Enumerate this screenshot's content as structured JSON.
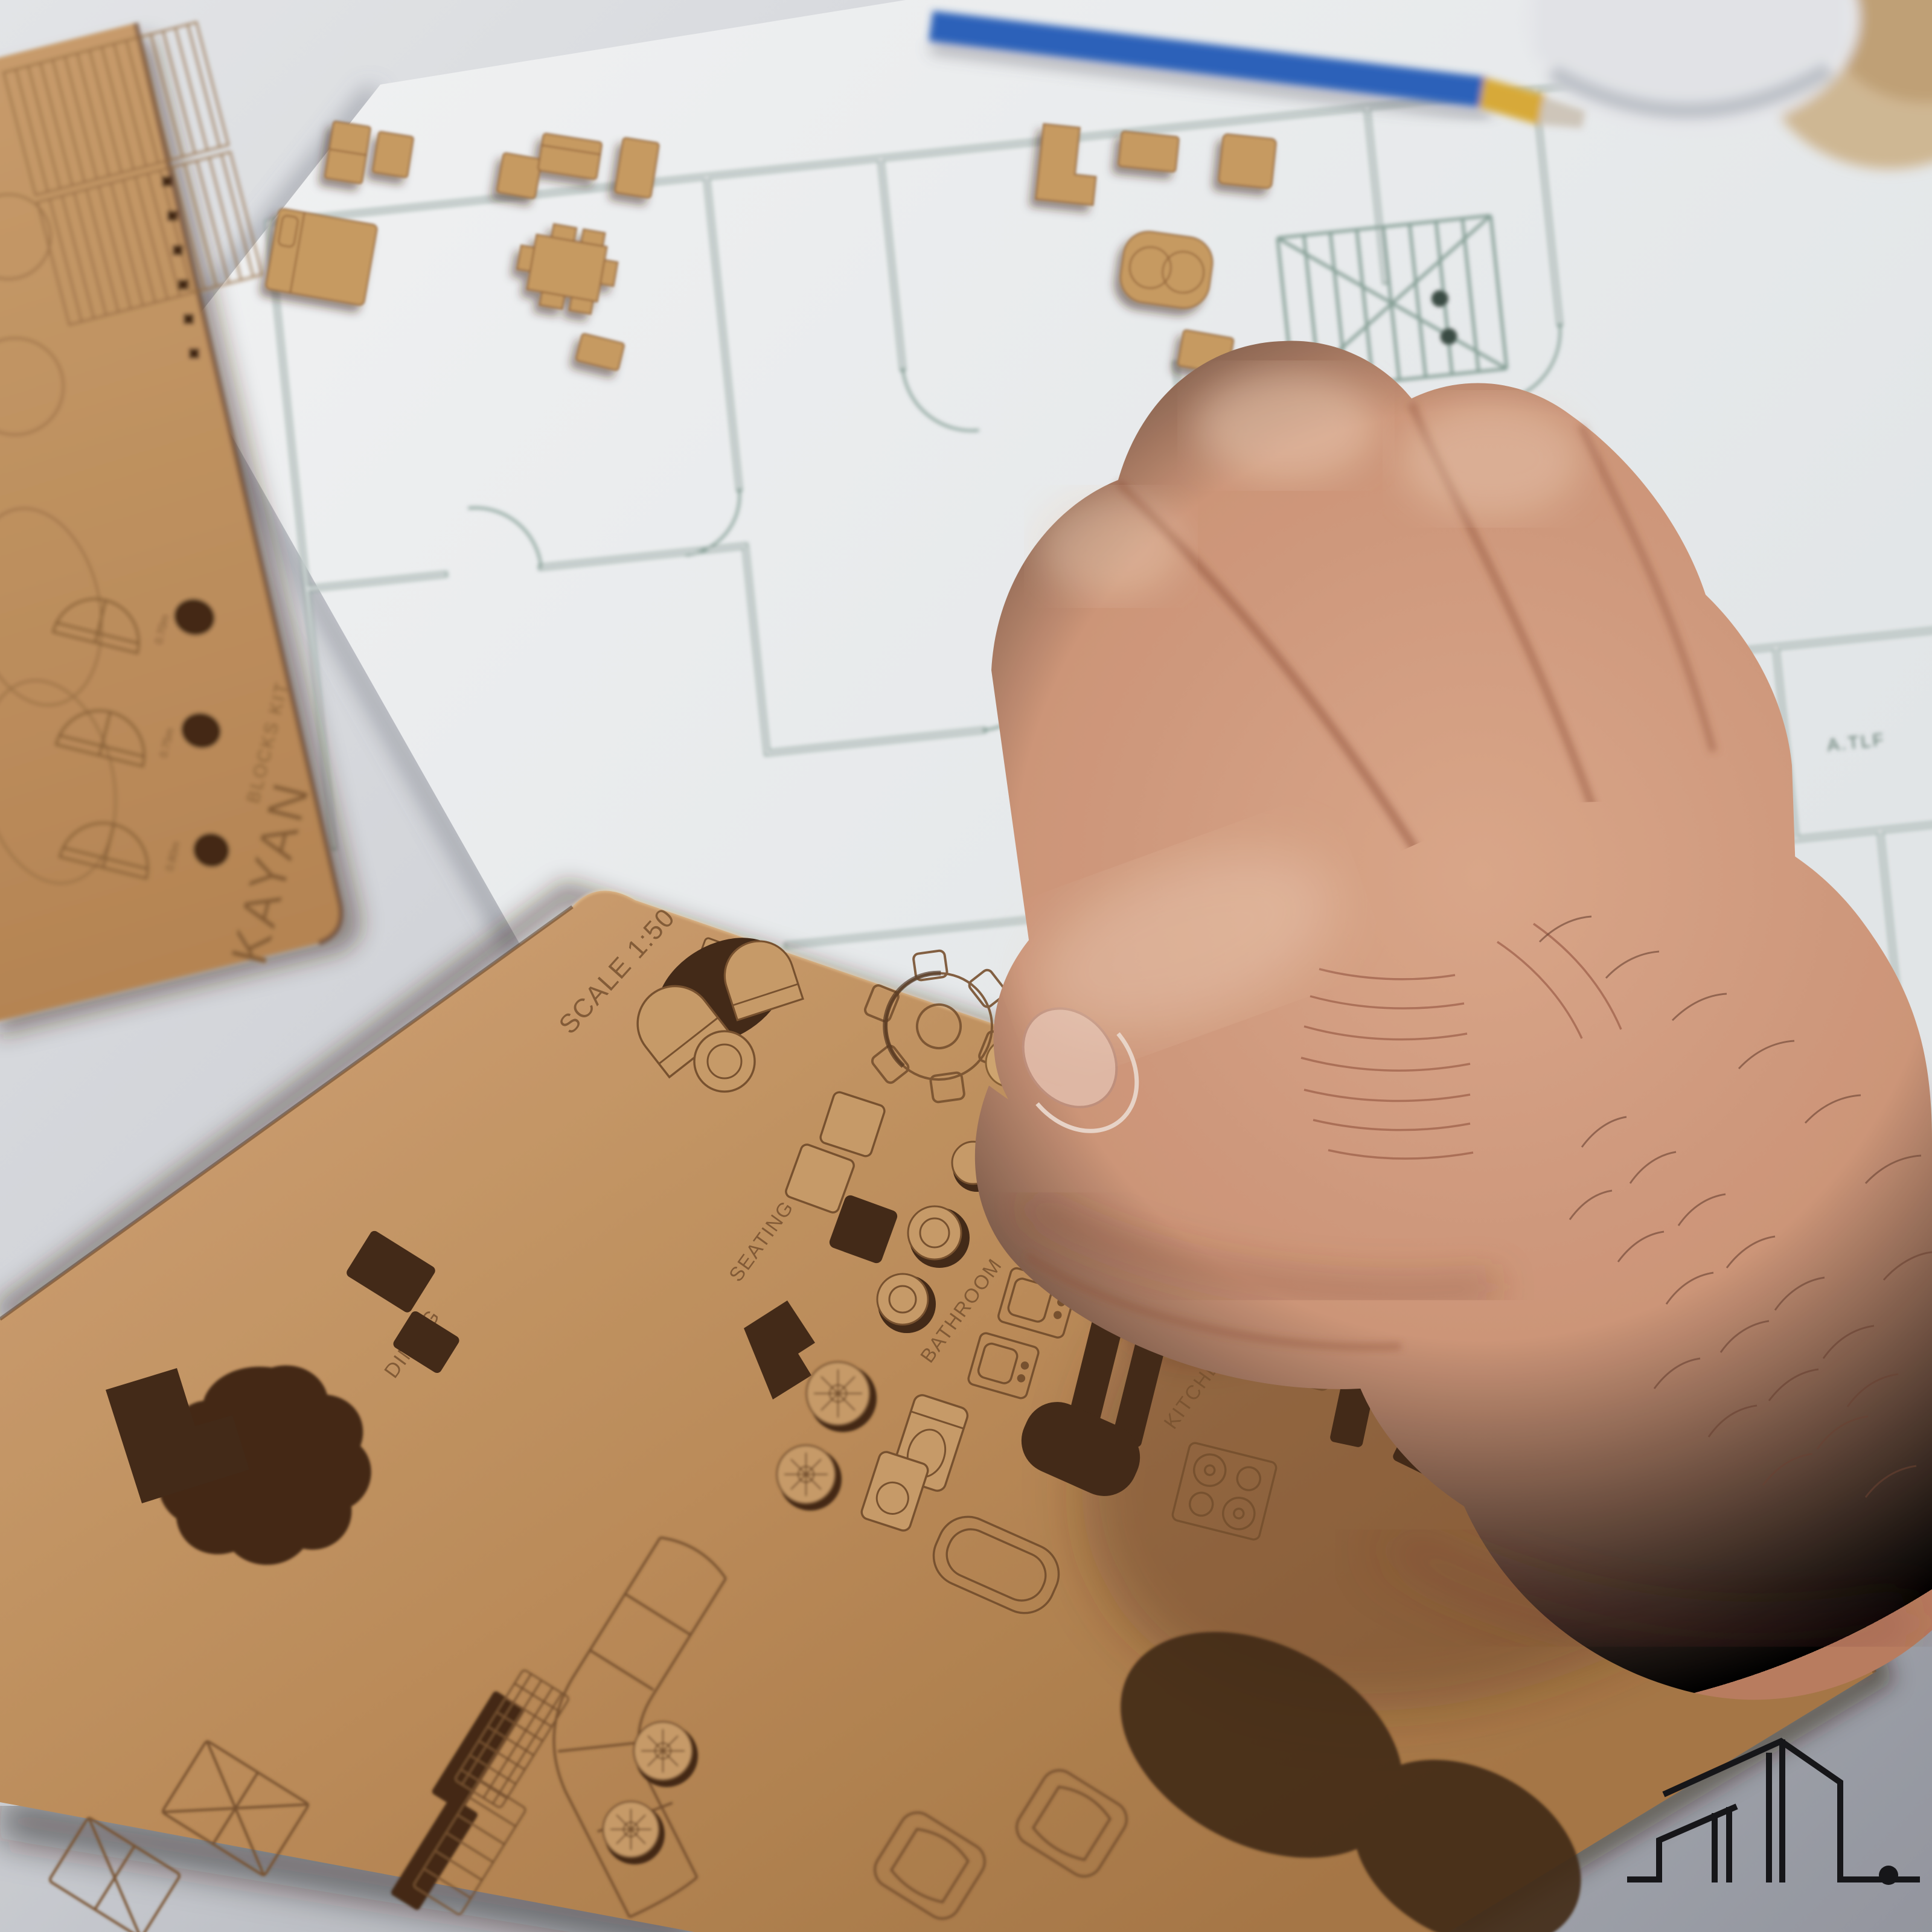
{
  "branding": {
    "left_template_title": "KAYAN",
    "left_template_subtitle": "BLOCKS KIT"
  },
  "left_template": {
    "door_size_labels": [
      "0.70m",
      "0.75m",
      "0.80m"
    ]
  },
  "main_template": {
    "scale_label": "SCALE 1:50",
    "category_labels": {
      "dining": "DINING",
      "seating": "SEATING",
      "bathroom": "BATHROOM",
      "kitchen": "KITCHEN"
    },
    "dimension_labels": [
      "1.5x0.6",
      "0.6x0.6",
      "0.5x0.6"
    ],
    "ruler": {
      "title": "SCALE RULER 1:50",
      "tick_labels": [
        "1m",
        "2m",
        "3m",
        "4m"
      ]
    }
  },
  "floor_plan": {
    "room_labels": [
      "A.TLT",
      "KIT",
      "KIT",
      "A.TLF"
    ]
  },
  "colors": {
    "desk_light": "#ecedf0",
    "desk_dark": "#9da0a8",
    "paper": "#f7f9fb",
    "plan_line": "#8aa59b",
    "wood": "#c79862",
    "wood_engrave": "#7d5531",
    "cutout_hole": "#462c19",
    "skin": "#d9a184",
    "pencil_blue": "#2f66c2",
    "pencil_tip_yellow": "#e2b23a",
    "logo_ink": "#17171a"
  },
  "icons": {
    "logo": "building-skyline-logo-with-dot"
  }
}
